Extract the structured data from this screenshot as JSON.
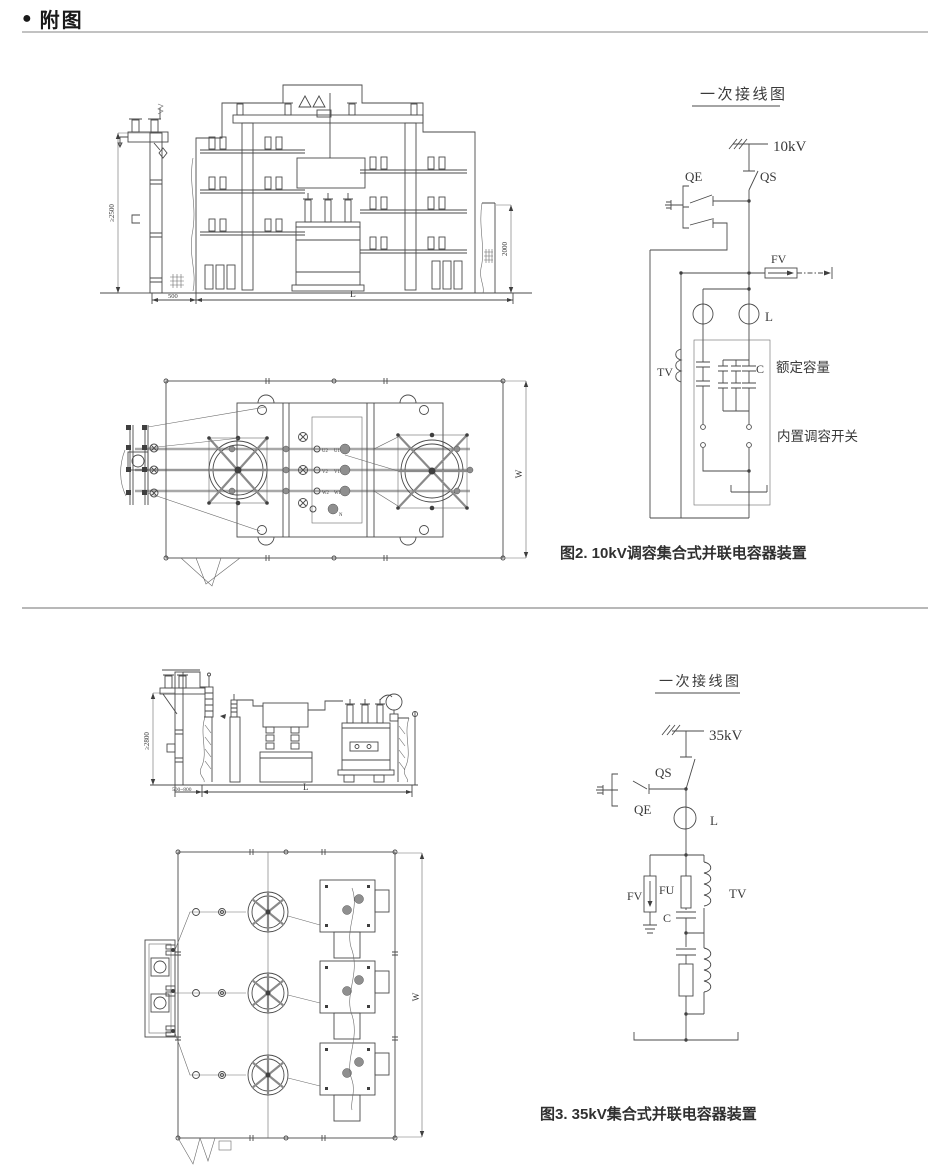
{
  "header": {
    "bullet": "●",
    "title": "附图"
  },
  "figure2": {
    "caption": "图2. 10kV调容集合式并联电容器装置",
    "front": {
      "dim_height": "≥2500",
      "dim_offset": "500",
      "dim_length": "L",
      "dim_fence": "2000"
    },
    "plan": {
      "dim_width": "W",
      "terminals": {
        "u2": "U2",
        "u1": "U1",
        "v2": "V2",
        "v1": "V1",
        "w2": "W2",
        "w1": "W1",
        "n": "N"
      }
    },
    "oneline": {
      "title": "一次接线图",
      "voltage": "10kV",
      "qs": "QS",
      "qe": "QE",
      "fv": "FV",
      "l": "L",
      "tv": "TV",
      "c": "C",
      "rated_capacity": "额定容量",
      "builtin_switch": "内置调容开关"
    }
  },
  "figure3": {
    "caption": "图3. 35kV集合式并联电容器装置",
    "front": {
      "dim_height": "≥2800",
      "dim_offset": "500~800",
      "dim_length": "L"
    },
    "plan": {
      "dim_width": "W"
    },
    "oneline": {
      "title": "一次接线图",
      "voltage": "35kV",
      "qs": "QS",
      "qe": "QE",
      "l": "L",
      "fv": "FV",
      "fu": "FU",
      "tv": "TV",
      "c": "C"
    }
  }
}
